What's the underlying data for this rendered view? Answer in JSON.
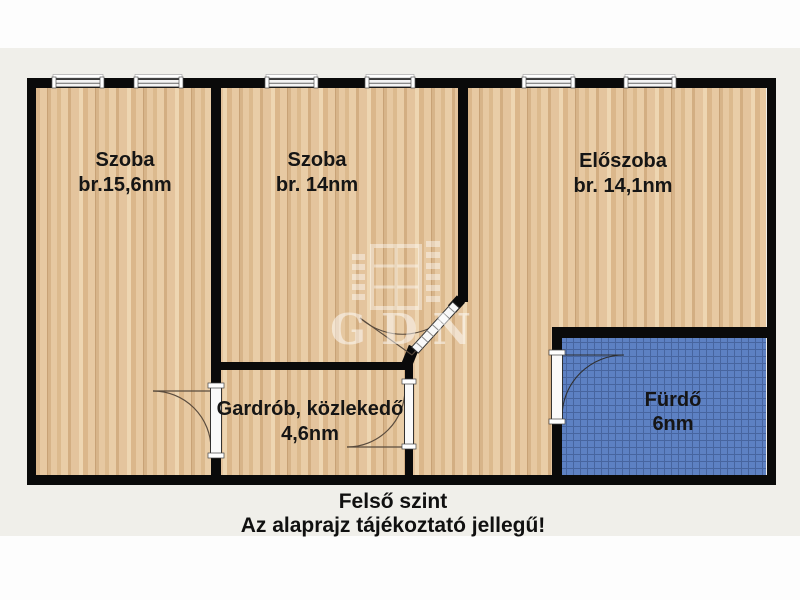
{
  "floorplan": {
    "caption": {
      "line1": "Felső szint",
      "line2": "Az alaprajz tájékoztató jellegű!"
    },
    "watermark": {
      "text": "GDN"
    },
    "rooms": [
      {
        "name": "Szoba",
        "area": "br.15,6nm"
      },
      {
        "name": "Szoba",
        "area": "br. 14nm"
      },
      {
        "name": "Előszoba",
        "area": "br. 14,1nm"
      },
      {
        "name": "Gardrób, közlekedő",
        "area": "4,6nm"
      },
      {
        "name": "Fürdő",
        "area": "6nm"
      }
    ],
    "colors": {
      "wall": "#0a0a0a",
      "floor_wood": "#e2c19a",
      "bathroom_tile": "#5d81c3",
      "background_band": "#f0efea",
      "page_background": "#fdfdfd"
    }
  }
}
